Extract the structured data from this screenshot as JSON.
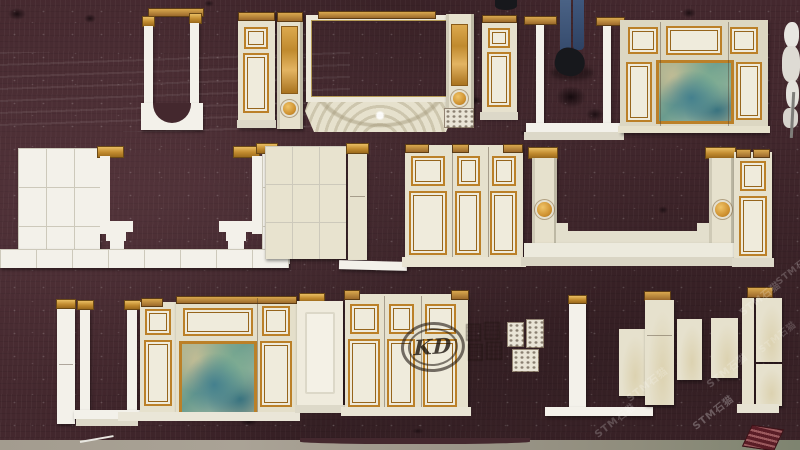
{
  "watermarks": {
    "kd": "KD",
    "stm": "STM石猫"
  },
  "palette": {
    "floor": "#44282e",
    "floor_light": "#5d3e46",
    "concrete": "#a39c8f",
    "cream": "#e6e1cd",
    "cream_light": "#efebdc",
    "stone_white": "#f3f1ea",
    "grout": "#cdc9bb",
    "gold": "#bb8028",
    "gold_dark": "#96651c",
    "wood": "#9c6a2c",
    "wood_light": "#d9a84e",
    "marble_tan": "#cf9a3d",
    "onyx_green": "#7fae92",
    "onyx_teal": "#44808e",
    "onyx_sand": "#c9bf96",
    "jeans_blue": "#4a6285",
    "shoe_dark": "#17181c",
    "tag_red": "#5a1d26",
    "watermark_white": "#ffffff"
  }
}
